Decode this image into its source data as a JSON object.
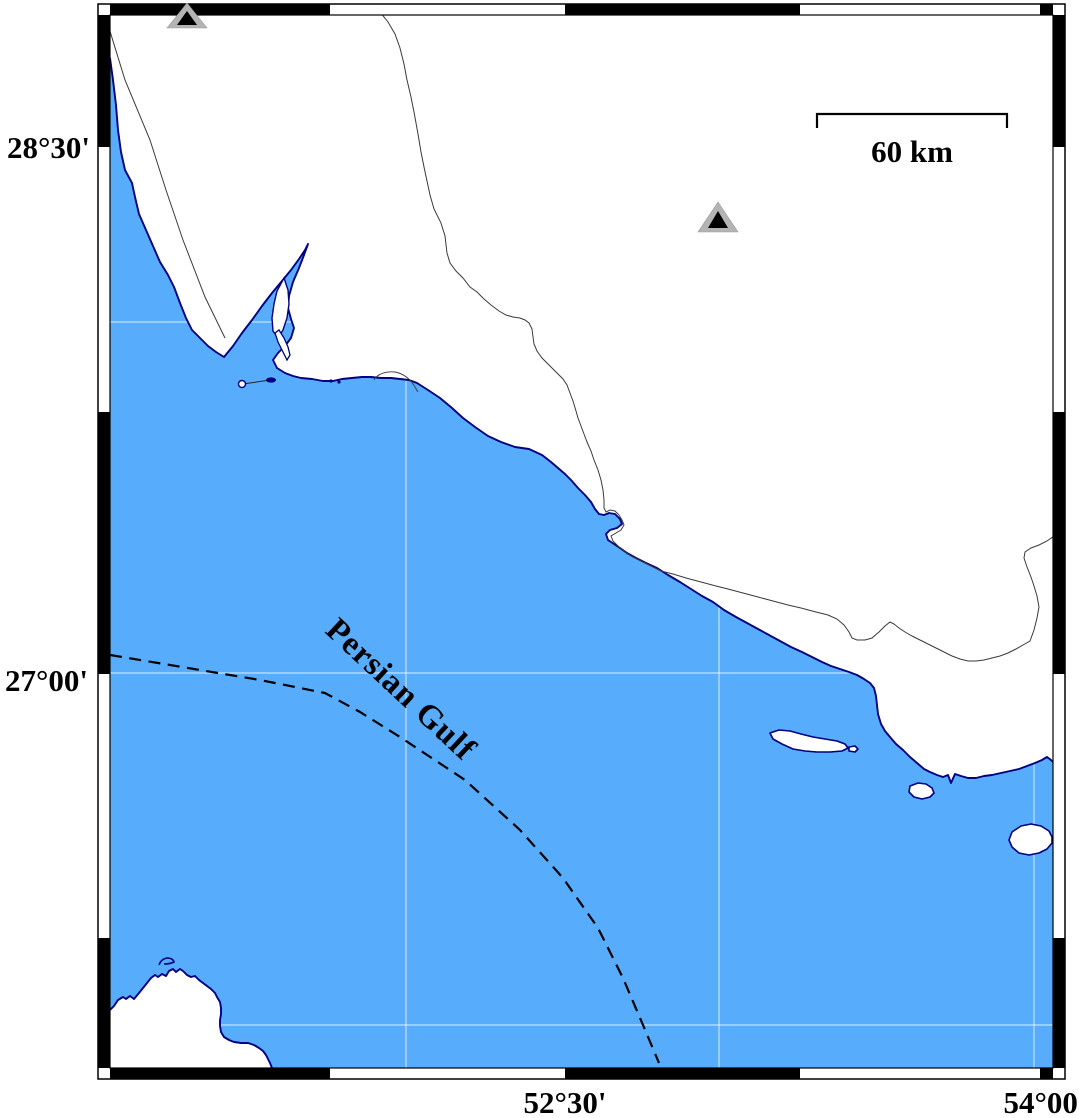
{
  "map": {
    "sea_label": "Persian Gulf",
    "scale_bar": {
      "label": "60 km"
    },
    "y_axis": {
      "labels": [
        {
          "text": "28°30'"
        },
        {
          "text": "27°00'"
        }
      ]
    },
    "x_axis": {
      "labels": [
        {
          "text": "52°30'"
        },
        {
          "text": "54°00'"
        }
      ]
    },
    "stations": [
      {
        "x": 187,
        "y": 19
      },
      {
        "x": 718,
        "y": 220
      }
    ],
    "gridlines": {
      "vertical_x": [
        406,
        719,
        1034
      ],
      "horizontal_y": [
        322,
        673,
        1025
      ]
    },
    "colors": {
      "sea": "#57acfb",
      "land": "#ffffff",
      "coast": "#000080",
      "frame_black": "#000000",
      "frame_white": "#ffffff",
      "border_line": "#3a3a3a",
      "boundary_dashed": "#000000",
      "grid": "#e8f4ff",
      "station_fill": "#b4b4b4",
      "station_core": "#000000"
    }
  }
}
